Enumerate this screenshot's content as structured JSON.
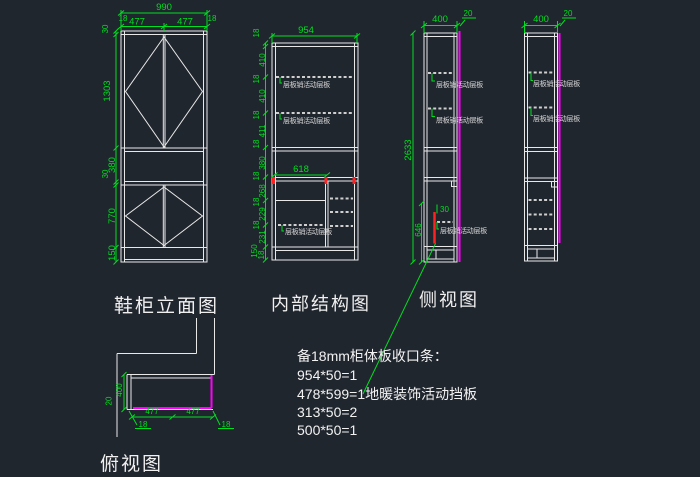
{
  "colors": {
    "background": "#20262e",
    "drawing_line": "#e8e8e8",
    "dimension": "#00df20",
    "highlight_magenta": "#ff00ff",
    "highlight_red": "#ff2222"
  },
  "labels": {
    "movable_shelf": "层板销活动层板"
  },
  "elevation": {
    "caption": "鞋柜立面图",
    "dim_total_width": "990",
    "dim_side_left": "18",
    "dim_door_left": "477",
    "dim_door_right": "477",
    "dim_side_right": "18",
    "dim_top_rail": "30",
    "dim_upper_doors": "1303",
    "dim_niche": "380",
    "dim_gap": "30",
    "dim_lower_doors": "770",
    "dim_base": "150"
  },
  "internal": {
    "caption": "内部结构图",
    "dim_width": "954",
    "dim_opening": "618",
    "left_chain": [
      "18",
      "410",
      "18",
      "410",
      "18",
      "411",
      "18",
      "380",
      "18",
      "268",
      "18",
      "229",
      "18",
      "231",
      "150",
      "18"
    ]
  },
  "side": {
    "caption": "侧视图",
    "dim_depth": "400",
    "dim_lip": "20",
    "dim_total_height": "2633",
    "dim_gap": "30",
    "dim_lower": "646"
  },
  "side2": {
    "dim_depth": "400",
    "dim_lip": "20"
  },
  "plan": {
    "caption": "俯视图",
    "dim_depth": "400",
    "dim_lip": "20",
    "dim_door_left": "477",
    "dim_door_right": "477",
    "dim_edge_left": "18",
    "dim_edge_right": "18"
  },
  "notes": {
    "title": "备18mm柜体板收口条：",
    "lines": [
      "954*50=1",
      "478*599=1地暖装饰活动挡板",
      "313*50=2",
      "500*50=1"
    ]
  }
}
